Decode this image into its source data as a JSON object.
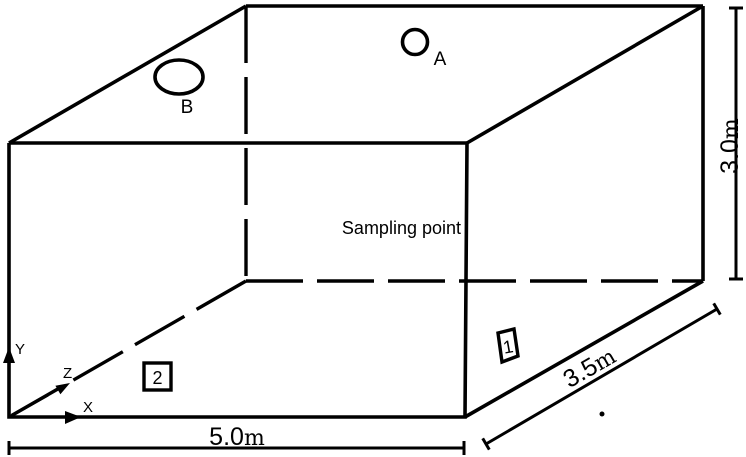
{
  "diagram": {
    "colors": {
      "line": "#000000",
      "background": "#ffffff"
    },
    "labels": {
      "sampling_point": "Sampling point",
      "point_a": "A",
      "point_b": "B",
      "marker_1": "1",
      "marker_2": "2"
    },
    "axes": {
      "x": "X",
      "y": "Y",
      "z": "Z"
    },
    "dimensions": {
      "width": {
        "value": "5.0",
        "unit": "m"
      },
      "depth": {
        "value": "3.5",
        "unit": "m"
      },
      "height": {
        "value": "3.0",
        "unit": "m"
      }
    }
  }
}
